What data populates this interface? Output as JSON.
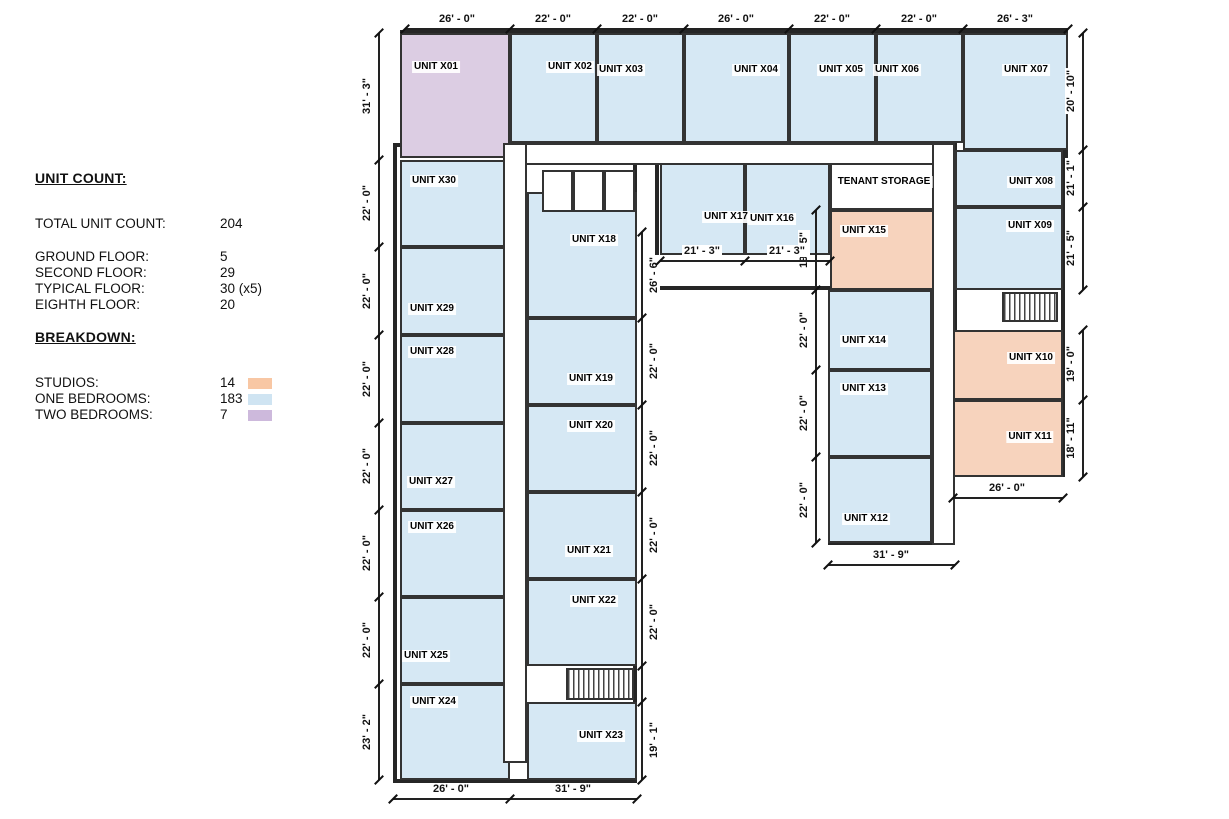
{
  "legend": {
    "title": "UNIT COUNT:",
    "rows": [
      {
        "label": "TOTAL UNIT COUNT:",
        "value": "204",
        "gap_after": true
      },
      {
        "label": "GROUND FLOOR:",
        "value": "5"
      },
      {
        "label": "SECOND FLOOR:",
        "value": "29"
      },
      {
        "label": "TYPICAL FLOOR:",
        "value": "30 (x5)"
      },
      {
        "label": "EIGHTH FLOOR:",
        "value": "20"
      }
    ],
    "breakdown_title": "BREAKDOWN:",
    "breakdown": [
      {
        "label": "STUDIOS:",
        "value": "14",
        "type": "studio"
      },
      {
        "label": "ONE BEDROOMS:",
        "value": "183",
        "type": "one"
      },
      {
        "label": "TWO BEDROOMS:",
        "value": "7",
        "type": "two"
      }
    ]
  },
  "colors": {
    "fill": {
      "one": "#d6e8f4",
      "studio": "#f7d3bd",
      "two": "#dccde3",
      "storage": "#ffffff"
    },
    "swatch": {
      "one": "#cfe4f2",
      "studio": "#f8c7a4",
      "two": "#cdb9dc"
    },
    "wall": "#2e2e2e"
  },
  "plan": {
    "wings": [
      {
        "x": 400,
        "y": 30,
        "w": 668,
        "h": 133
      },
      {
        "x": 953,
        "y": 30,
        "w": 112,
        "h": 447
      },
      {
        "x": 828,
        "y": 143,
        "w": 127,
        "h": 402
      },
      {
        "x": 655,
        "y": 143,
        "w": 283,
        "h": 147
      },
      {
        "x": 393,
        "y": 143,
        "w": 244,
        "h": 640
      }
    ],
    "rooms": [
      {
        "id": "x01",
        "label": "UNIT X01",
        "type": "two",
        "x": 400,
        "y": 33,
        "w": 110,
        "h": 125,
        "lx": 436,
        "ly": 67
      },
      {
        "id": "x02",
        "label": "UNIT X02",
        "type": "one",
        "x": 510,
        "y": 33,
        "w": 87,
        "h": 110,
        "lx": 570,
        "ly": 67
      },
      {
        "id": "x03",
        "label": "UNIT X03",
        "type": "one",
        "x": 597,
        "y": 33,
        "w": 87,
        "h": 110,
        "lx": 621,
        "ly": 70
      },
      {
        "id": "x04",
        "label": "UNIT X04",
        "type": "one",
        "x": 684,
        "y": 33,
        "w": 105,
        "h": 110,
        "lx": 756,
        "ly": 70
      },
      {
        "id": "x05",
        "label": "UNIT X05",
        "type": "one",
        "x": 789,
        "y": 33,
        "w": 87,
        "h": 110,
        "lx": 841,
        "ly": 70
      },
      {
        "id": "x06",
        "label": "UNIT X06",
        "type": "one",
        "x": 876,
        "y": 33,
        "w": 87,
        "h": 110,
        "lx": 897,
        "ly": 70
      },
      {
        "id": "x07",
        "label": "UNIT X07",
        "type": "one",
        "x": 963,
        "y": 33,
        "w": 105,
        "h": 117,
        "lx": 1026,
        "ly": 70
      },
      {
        "id": "x08",
        "label": "UNIT X08",
        "type": "one",
        "x": 955,
        "y": 150,
        "w": 108,
        "h": 57,
        "lx": 1031,
        "ly": 182
      },
      {
        "id": "x09",
        "label": "UNIT X09",
        "type": "one",
        "x": 955,
        "y": 207,
        "w": 108,
        "h": 83,
        "lx": 1030,
        "ly": 226
      },
      {
        "id": "x10",
        "label": "UNIT X10",
        "type": "studio",
        "x": 953,
        "y": 330,
        "w": 110,
        "h": 70,
        "lx": 1031,
        "ly": 358
      },
      {
        "id": "x11",
        "label": "UNIT X11",
        "type": "studio",
        "x": 953,
        "y": 400,
        "w": 110,
        "h": 77,
        "lx": 1030,
        "ly": 437
      },
      {
        "id": "x12",
        "label": "UNIT X12",
        "type": "one",
        "x": 828,
        "y": 457,
        "w": 104,
        "h": 86,
        "lx": 866,
        "ly": 519
      },
      {
        "id": "x13",
        "label": "UNIT X13",
        "type": "one",
        "x": 828,
        "y": 370,
        "w": 104,
        "h": 87,
        "lx": 864,
        "ly": 389
      },
      {
        "id": "x14",
        "label": "UNIT X14",
        "type": "one",
        "x": 828,
        "y": 290,
        "w": 104,
        "h": 80,
        "lx": 864,
        "ly": 341
      },
      {
        "id": "x15",
        "label": "UNIT X15",
        "type": "studio",
        "x": 830,
        "y": 210,
        "w": 108,
        "h": 80,
        "lx": 864,
        "ly": 231
      },
      {
        "id": "x16",
        "label": "UNIT X16",
        "type": "one",
        "x": 745,
        "y": 160,
        "w": 85,
        "h": 95,
        "lx": 772,
        "ly": 219
      },
      {
        "id": "x17",
        "label": "UNIT X17",
        "type": "one",
        "x": 660,
        "y": 160,
        "w": 85,
        "h": 95,
        "lx": 726,
        "ly": 217
      },
      {
        "id": "x18",
        "label": "UNIT X18",
        "type": "one",
        "x": 527,
        "y": 192,
        "w": 110,
        "h": 126,
        "lx": 594,
        "ly": 240
      },
      {
        "id": "x19",
        "label": "UNIT X19",
        "type": "one",
        "x": 527,
        "y": 318,
        "w": 110,
        "h": 87,
        "lx": 591,
        "ly": 379
      },
      {
        "id": "x20",
        "label": "UNIT X20",
        "type": "one",
        "x": 527,
        "y": 405,
        "w": 110,
        "h": 87,
        "lx": 591,
        "ly": 426
      },
      {
        "id": "x21",
        "label": "UNIT X21",
        "type": "one",
        "x": 527,
        "y": 492,
        "w": 110,
        "h": 87,
        "lx": 589,
        "ly": 551
      },
      {
        "id": "x22",
        "label": "UNIT X22",
        "type": "one",
        "x": 527,
        "y": 579,
        "w": 110,
        "h": 87,
        "lx": 594,
        "ly": 601
      },
      {
        "id": "x23",
        "label": "UNIT X23",
        "type": "one",
        "x": 527,
        "y": 702,
        "w": 110,
        "h": 78,
        "lx": 601,
        "ly": 736
      },
      {
        "id": "x24",
        "label": "UNIT X24",
        "type": "one",
        "x": 400,
        "y": 684,
        "w": 110,
        "h": 96,
        "lx": 434,
        "ly": 702
      },
      {
        "id": "x25",
        "label": "UNIT X25",
        "type": "one",
        "x": 400,
        "y": 597,
        "w": 110,
        "h": 87,
        "lx": 426,
        "ly": 656
      },
      {
        "id": "x26",
        "label": "UNIT X26",
        "type": "one",
        "x": 400,
        "y": 510,
        "w": 110,
        "h": 87,
        "lx": 432,
        "ly": 527
      },
      {
        "id": "x27",
        "label": "UNIT X27",
        "type": "one",
        "x": 400,
        "y": 423,
        "w": 110,
        "h": 87,
        "lx": 431,
        "ly": 482
      },
      {
        "id": "x28",
        "label": "UNIT X28",
        "type": "one",
        "x": 400,
        "y": 335,
        "w": 110,
        "h": 88,
        "lx": 432,
        "ly": 352
      },
      {
        "id": "x29",
        "label": "UNIT X29",
        "type": "one",
        "x": 400,
        "y": 247,
        "w": 110,
        "h": 88,
        "lx": 432,
        "ly": 309
      },
      {
        "id": "x30",
        "label": "UNIT X30",
        "type": "one",
        "x": 400,
        "y": 160,
        "w": 110,
        "h": 87,
        "lx": 434,
        "ly": 181
      },
      {
        "id": "tenant-storage",
        "label": "TENANT STORAGE",
        "type": "storage",
        "x": 830,
        "y": 160,
        "w": 108,
        "h": 50,
        "lx": 884,
        "ly": 182
      }
    ],
    "corridors": [
      {
        "x": 503,
        "y": 143,
        "w": 452,
        "h": 22
      },
      {
        "x": 503,
        "y": 143,
        "w": 24,
        "h": 620
      },
      {
        "x": 932,
        "y": 143,
        "w": 23,
        "h": 402
      }
    ],
    "elevator_cells": [
      {
        "x": 542,
        "y": 170,
        "w": 31,
        "h": 42
      },
      {
        "x": 573,
        "y": 170,
        "w": 31,
        "h": 42
      },
      {
        "x": 604,
        "y": 170,
        "w": 31,
        "h": 42
      }
    ],
    "stairs": [
      {
        "x": 1002,
        "y": 292,
        "w": 56,
        "h": 30
      },
      {
        "x": 566,
        "y": 668,
        "w": 68,
        "h": 32
      }
    ],
    "dim_chains": [
      {
        "orient": "h",
        "pos": 28,
        "from": 405,
        "to": 1068,
        "side": "before",
        "ticks": [
          405,
          510,
          597,
          684,
          789,
          876,
          963,
          1068
        ],
        "labels": [
          {
            "t": "26' - 0\"",
            "at": 457
          },
          {
            "t": "22' - 0\"",
            "at": 553
          },
          {
            "t": "22' - 0\"",
            "at": 640
          },
          {
            "t": "26' - 0\"",
            "at": 736
          },
          {
            "t": "22' - 0\"",
            "at": 832
          },
          {
            "t": "22' - 0\"",
            "at": 919
          },
          {
            "t": "26' - 3\"",
            "at": 1015
          }
        ]
      },
      {
        "orient": "v",
        "pos": 378,
        "from": 33,
        "to": 780,
        "side": "before",
        "ticks": [
          33,
          160,
          247,
          335,
          423,
          510,
          597,
          684,
          780
        ],
        "labels": [
          {
            "t": "31' - 3\"",
            "at": 96
          },
          {
            "t": "22' - 0\"",
            "at": 203
          },
          {
            "t": "22' - 0\"",
            "at": 291
          },
          {
            "t": "22' - 0\"",
            "at": 379
          },
          {
            "t": "22' - 0\"",
            "at": 466
          },
          {
            "t": "22' - 0\"",
            "at": 553
          },
          {
            "t": "22' - 0\"",
            "at": 640
          },
          {
            "t": "23' - 2\"",
            "at": 732
          }
        ]
      },
      {
        "orient": "v",
        "pos": 1082,
        "from": 33,
        "to": 290,
        "side": "before",
        "ticks": [
          33,
          150,
          207,
          290
        ],
        "labels": [
          {
            "t": "20' - 10\"",
            "at": 91
          },
          {
            "t": "21' - 1\"",
            "at": 178
          },
          {
            "t": "21' - 5\"",
            "at": 248
          }
        ]
      },
      {
        "orient": "v",
        "pos": 1082,
        "from": 330,
        "to": 477,
        "side": "before",
        "ticks": [
          330,
          400,
          477
        ],
        "labels": [
          {
            "t": "19' - 0\"",
            "at": 364
          },
          {
            "t": "18' - 11\"",
            "at": 438
          }
        ]
      },
      {
        "orient": "h",
        "pos": 497,
        "from": 953,
        "to": 1063,
        "side": "before",
        "ticks": [
          953,
          1063
        ],
        "labels": [
          {
            "t": "26' - 0\"",
            "at": 1007
          }
        ]
      },
      {
        "orient": "h",
        "pos": 564,
        "from": 828,
        "to": 955,
        "side": "before",
        "ticks": [
          828,
          955
        ],
        "labels": [
          {
            "t": "31' - 9\"",
            "at": 891
          }
        ]
      },
      {
        "orient": "v",
        "pos": 815,
        "from": 210,
        "to": 543,
        "side": "before",
        "ticks": [
          210,
          290,
          370,
          457,
          543
        ],
        "labels": [
          {
            "t": "19' - 5\"",
            "at": 250
          },
          {
            "t": "22' - 0\"",
            "at": 330
          },
          {
            "t": "22' - 0\"",
            "at": 413
          },
          {
            "t": "22' - 0\"",
            "at": 500
          }
        ]
      },
      {
        "orient": "v",
        "pos": 641,
        "from": 232,
        "to": 780,
        "side": "after",
        "ticks": [
          232,
          318,
          405,
          492,
          579,
          666,
          702,
          780
        ],
        "labels": [
          {
            "t": "26' - 6\"",
            "at": 275
          },
          {
            "t": "22' - 0\"",
            "at": 361
          },
          {
            "t": "22' - 0\"",
            "at": 448
          },
          {
            "t": "22' - 0\"",
            "at": 535
          },
          {
            "t": "22' - 0\"",
            "at": 622
          },
          {
            "t": "19' - 1\"",
            "at": 740
          }
        ]
      },
      {
        "orient": "h",
        "pos": 260,
        "from": 660,
        "to": 830,
        "side": "before",
        "ticks": [
          660,
          745,
          830
        ],
        "labels": [
          {
            "t": "21' - 3\"",
            "at": 702
          },
          {
            "t": "21' - 3\"",
            "at": 787
          }
        ]
      },
      {
        "orient": "h",
        "pos": 798,
        "from": 393,
        "to": 637,
        "side": "before",
        "ticks": [
          393,
          510,
          637
        ],
        "labels": [
          {
            "t": "26' - 0\"",
            "at": 451
          },
          {
            "t": "31' - 9\"",
            "at": 573
          }
        ]
      }
    ]
  }
}
